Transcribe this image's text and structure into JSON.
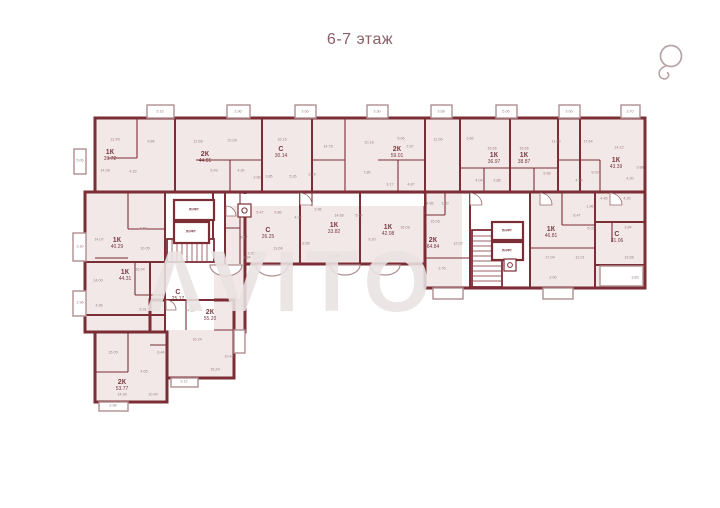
{
  "header": {
    "title": "6-7 этаж"
  },
  "watermark": {
    "text": "ΛVITO"
  },
  "icons": {
    "compass": "compass-icon",
    "trash_chute": "trash-chute-icon"
  },
  "plan": {
    "apartments": [
      {
        "type": "1К",
        "area": "39.72",
        "x": 110,
        "y": 156
      },
      {
        "type": "2К",
        "area": "44.81",
        "x": 205,
        "y": 158
      },
      {
        "type": "С",
        "area": "30.14",
        "x": 281,
        "y": 153
      },
      {
        "type": "2К",
        "area": "59.01",
        "x": 397,
        "y": 153
      },
      {
        "type": "1К",
        "area": "36.97",
        "x": 494,
        "y": 159
      },
      {
        "type": "1К",
        "area": "38.87",
        "x": 524,
        "y": 159
      },
      {
        "type": "1К",
        "area": "43.39",
        "x": 616,
        "y": 164
      },
      {
        "type": "С",
        "area": "26.25",
        "x": 268,
        "y": 234
      },
      {
        "type": "1К",
        "area": "33.82",
        "x": 334,
        "y": 229
      },
      {
        "type": "1К",
        "area": "42.08",
        "x": 388,
        "y": 231
      },
      {
        "type": "2К",
        "area": "64.84",
        "x": 433,
        "y": 244
      },
      {
        "type": "1К",
        "area": "46.81",
        "x": 551,
        "y": 233
      },
      {
        "type": "С",
        "area": "31.06",
        "x": 617,
        "y": 238
      },
      {
        "type": "1К",
        "area": "40.29",
        "x": 117,
        "y": 244
      },
      {
        "type": "1К",
        "area": "44.31",
        "x": 125,
        "y": 276
      },
      {
        "type": "С",
        "area": "25.17",
        "x": 178,
        "y": 296
      },
      {
        "type": "2К",
        "area": "55.20",
        "x": 210,
        "y": 316
      },
      {
        "type": "2К",
        "area": "53.77",
        "x": 122,
        "y": 386
      }
    ],
    "elevators": [
      {
        "label": "ЛИФТ",
        "x": 194,
        "y": 210
      },
      {
        "label": "ЛИФТ",
        "x": 191,
        "y": 232
      },
      {
        "label": "ЛИФТ",
        "x": 507,
        "y": 231
      },
      {
        "label": "ЛИФТ",
        "x": 507,
        "y": 251
      }
    ],
    "room_areas": [
      {
        "t": "5.16",
        "x": 160,
        "y": 112
      },
      {
        "t": "2.96",
        "x": 238,
        "y": 112
      },
      {
        "t": "3.06",
        "x": 305,
        "y": 112
      },
      {
        "t": "3.30",
        "x": 377,
        "y": 112
      },
      {
        "t": "3.08",
        "x": 441,
        "y": 112
      },
      {
        "t": "5.06",
        "x": 506,
        "y": 112
      },
      {
        "t": "3.06",
        "x": 569,
        "y": 112
      },
      {
        "t": "3.70",
        "x": 630,
        "y": 112
      },
      {
        "t": "5.06",
        "x": 80,
        "y": 161
      },
      {
        "t": "3.30",
        "x": 80,
        "y": 247
      },
      {
        "t": "2.96",
        "x": 80,
        "y": 303
      },
      {
        "t": "2.98",
        "x": 113,
        "y": 406
      },
      {
        "t": "3.12",
        "x": 184,
        "y": 382
      },
      {
        "t": "12.45",
        "x": 115,
        "y": 140
      },
      {
        "t": "9.84",
        "x": 151,
        "y": 142
      },
      {
        "t": "14.08",
        "x": 105,
        "y": 171
      },
      {
        "t": "4.23",
        "x": 133,
        "y": 172
      },
      {
        "t": "12.66",
        "x": 198,
        "y": 142
      },
      {
        "t": "10.09",
        "x": 232,
        "y": 141
      },
      {
        "t": "5.43",
        "x": 214,
        "y": 171
      },
      {
        "t": "4.30",
        "x": 241,
        "y": 171
      },
      {
        "t": "3.83",
        "x": 257,
        "y": 178
      },
      {
        "t": "16.16",
        "x": 282,
        "y": 140
      },
      {
        "t": "3.85",
        "x": 269,
        "y": 177
      },
      {
        "t": "5.26",
        "x": 293,
        "y": 177
      },
      {
        "t": "14.75",
        "x": 328,
        "y": 147
      },
      {
        "t": "10.16",
        "x": 369,
        "y": 143
      },
      {
        "t": "7.80",
        "x": 367,
        "y": 173
      },
      {
        "t": "2.78",
        "x": 312,
        "y": 175
      },
      {
        "t": "5.06",
        "x": 401,
        "y": 139
      },
      {
        "t": "2.97",
        "x": 410,
        "y": 147
      },
      {
        "t": "3.17",
        "x": 390,
        "y": 185
      },
      {
        "t": "4.87",
        "x": 411,
        "y": 185
      },
      {
        "t": "11.06",
        "x": 438,
        "y": 140
      },
      {
        "t": "15.65",
        "x": 492,
        "y": 149
      },
      {
        "t": "15.65",
        "x": 524,
        "y": 149
      },
      {
        "t": "4.04",
        "x": 479,
        "y": 181
      },
      {
        "t": "2.88",
        "x": 497,
        "y": 181
      },
      {
        "t": "3.66",
        "x": 470,
        "y": 139
      },
      {
        "t": "11.68",
        "x": 556,
        "y": 142
      },
      {
        "t": "17.64",
        "x": 588,
        "y": 142
      },
      {
        "t": "5.69",
        "x": 547,
        "y": 174
      },
      {
        "t": "4.54",
        "x": 579,
        "y": 181
      },
      {
        "t": "8.03",
        "x": 595,
        "y": 173
      },
      {
        "t": "14.22",
        "x": 619,
        "y": 148
      },
      {
        "t": "4.20",
        "x": 630,
        "y": 179
      },
      {
        "t": "3.88",
        "x": 640,
        "y": 168
      },
      {
        "t": "4.45",
        "x": 604,
        "y": 199
      },
      {
        "t": "4.20",
        "x": 627,
        "y": 199
      },
      {
        "t": "3.84",
        "x": 628,
        "y": 228
      },
      {
        "t": "13.68",
        "x": 629,
        "y": 258
      },
      {
        "t": "3.83",
        "x": 635,
        "y": 278
      },
      {
        "t": "15.06",
        "x": 435,
        "y": 222
      },
      {
        "t": "12.02",
        "x": 458,
        "y": 244
      },
      {
        "t": "4.85",
        "x": 430,
        "y": 204
      },
      {
        "t": "3.60",
        "x": 445,
        "y": 204
      },
      {
        "t": "3.76",
        "x": 442,
        "y": 269
      },
      {
        "t": "17.04",
        "x": 550,
        "y": 258
      },
      {
        "t": "12.01",
        "x": 580,
        "y": 258
      },
      {
        "t": "8.47",
        "x": 577,
        "y": 216
      },
      {
        "t": "5.03",
        "x": 591,
        "y": 229
      },
      {
        "t": "1.96",
        "x": 590,
        "y": 207
      },
      {
        "t": "2.90",
        "x": 553,
        "y": 278
      },
      {
        "t": "5.47",
        "x": 260,
        "y": 213
      },
      {
        "t": "6.86",
        "x": 278,
        "y": 213
      },
      {
        "t": "4.03",
        "x": 298,
        "y": 218
      },
      {
        "t": "2.96",
        "x": 318,
        "y": 210
      },
      {
        "t": "14.68",
        "x": 339,
        "y": 216
      },
      {
        "t": "8.99",
        "x": 306,
        "y": 244
      },
      {
        "t": "13.66",
        "x": 278,
        "y": 249
      },
      {
        "t": "3.29",
        "x": 251,
        "y": 254
      },
      {
        "t": "3.94",
        "x": 336,
        "y": 256
      },
      {
        "t": "9.20",
        "x": 372,
        "y": 240
      },
      {
        "t": "16.08",
        "x": 405,
        "y": 228
      },
      {
        "t": "5.54",
        "x": 359,
        "y": 216
      },
      {
        "t": "5.17",
        "x": 244,
        "y": 238
      },
      {
        "t": "3.24",
        "x": 247,
        "y": 258
      },
      {
        "t": "14.07",
        "x": 99,
        "y": 240
      },
      {
        "t": "2.88",
        "x": 143,
        "y": 229
      },
      {
        "t": "10.05",
        "x": 145,
        "y": 249
      },
      {
        "t": "16.94",
        "x": 140,
        "y": 270
      },
      {
        "t": "14.00",
        "x": 98,
        "y": 281
      },
      {
        "t": "6.31",
        "x": 143,
        "y": 310
      },
      {
        "t": "4.28",
        "x": 99,
        "y": 306
      },
      {
        "t": "16.24",
        "x": 197,
        "y": 340
      },
      {
        "t": "10.44",
        "x": 229,
        "y": 357
      },
      {
        "t": "15.24",
        "x": 215,
        "y": 370
      },
      {
        "t": "4.35",
        "x": 191,
        "y": 311
      },
      {
        "t": "15.05",
        "x": 113,
        "y": 353
      },
      {
        "t": "14.30",
        "x": 122,
        "y": 395
      },
      {
        "t": "10.94",
        "x": 153,
        "y": 395
      },
      {
        "t": "4.05",
        "x": 144,
        "y": 372
      },
      {
        "t": "6.44",
        "x": 161,
        "y": 353
      }
    ]
  }
}
